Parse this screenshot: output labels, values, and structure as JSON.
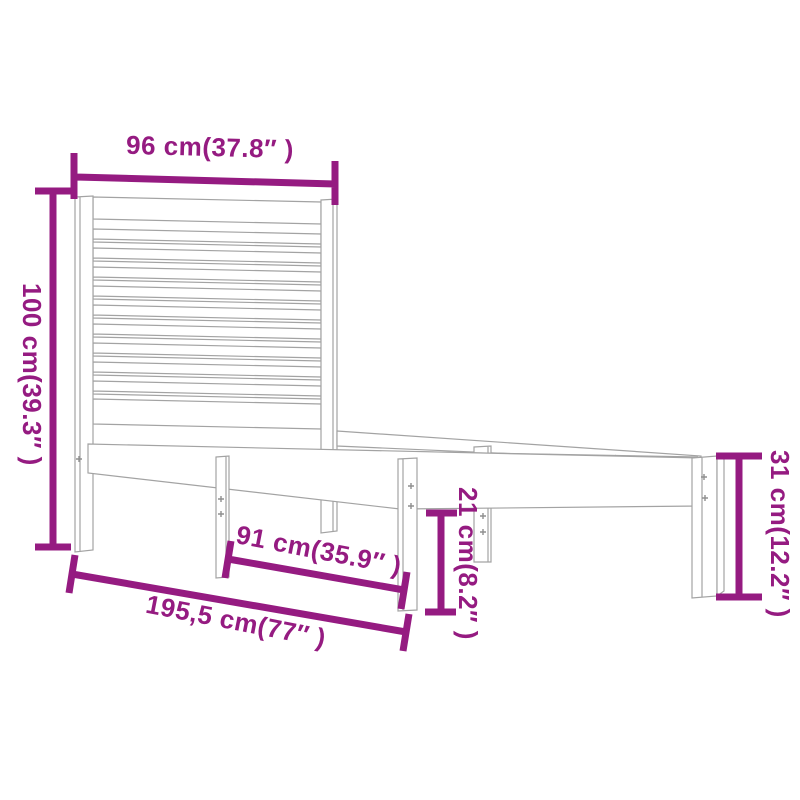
{
  "figure": {
    "subject": "wooden single bed frame with slatted headboard, dimension diagram"
  },
  "colors": {
    "dimension_accent": "#951B81",
    "drawing_line": "#a3a3a3",
    "background": "#ffffff"
  },
  "dimensions": {
    "headboard_width": "96 cm(37.8″ )",
    "headboard_height": "100 cm(39.3″ )",
    "center_leg_span": "91 cm(35.9″ )",
    "total_length": "195,5 cm(77″ )",
    "under_bed_clearance": "21 cm(8.2″ )",
    "frame_height": "31 cm(12.2″ )"
  }
}
